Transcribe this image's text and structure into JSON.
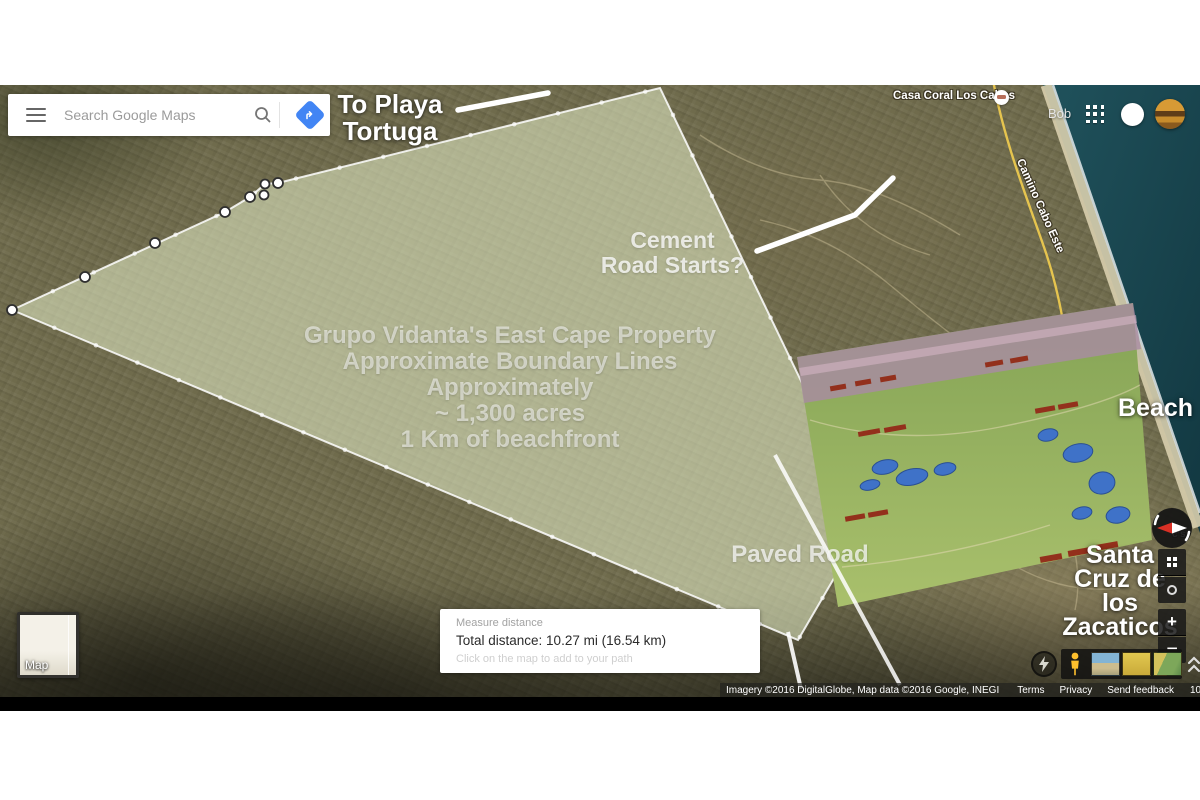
{
  "header": {
    "user_name": "Bob"
  },
  "search": {
    "placeholder": "Search Google Maps"
  },
  "annotations": {
    "to_playa": {
      "lines": [
        "To Playa",
        "Tortuga"
      ]
    },
    "cement": {
      "lines": [
        "Cement",
        "Road Starts?"
      ]
    },
    "property": {
      "lines": [
        "Grupo Vidanta's East Cape Property",
        "Approximate Boundary Lines",
        "Approximately",
        "~ 1,300 acres",
        "1 Km of beachfront"
      ]
    },
    "paved_road": {
      "text": "Paved Road"
    },
    "beach": {
      "text": "Beach"
    },
    "santa_cruz": {
      "lines": [
        "Santa",
        "Cruz de",
        "los",
        "Zacaticos"
      ]
    }
  },
  "map_labels": {
    "casa_coral": "Casa Coral Los Cabos",
    "camino_cabo_este": "Camino Cabo Este",
    "partial_label": "c's"
  },
  "measure_panel": {
    "title": "Measure distance",
    "total": "Total distance: 10.27 mi (16.54 km)",
    "hint": "Click on the map to add to your path"
  },
  "map_type_toggle": {
    "label": "Map"
  },
  "attribution": {
    "imagery": "Imagery ©2016 DigitalGlobe, Map data ©2016 Google, INEGI",
    "terms": "Terms",
    "privacy": "Privacy",
    "send_feedback": "Send feedback",
    "scale_label": "1000 ft"
  },
  "controls": {
    "zoom_in": "+",
    "zoom_out": "−"
  },
  "icons": {
    "menu": "hamburger-menu-icon",
    "search": "search-icon",
    "directions": "directions-icon",
    "apps": "apps-grid-icon",
    "notifications": "notification-circle-icon",
    "avatar": "user-avatar",
    "compass": "compass-icon",
    "imagery_grid": "imagery-grid-icon",
    "my_location": "my-location-icon",
    "pegman": "pegman-icon",
    "lightning": "lite-mode-lightning-icon",
    "expand": "chevron-up-icon",
    "lodging": "lodging-poi-icon"
  },
  "colors": {
    "accent_blue": "#4285f4",
    "ocean": "#1d4b54",
    "terrain": "#6f6b4c",
    "overlay_green": "#e6eec8",
    "resort_green": "#8aa758",
    "pegman_yellow": "#fdbf2d",
    "road_yellow": "#ecc94f",
    "annotation_white": "#ffffff"
  }
}
